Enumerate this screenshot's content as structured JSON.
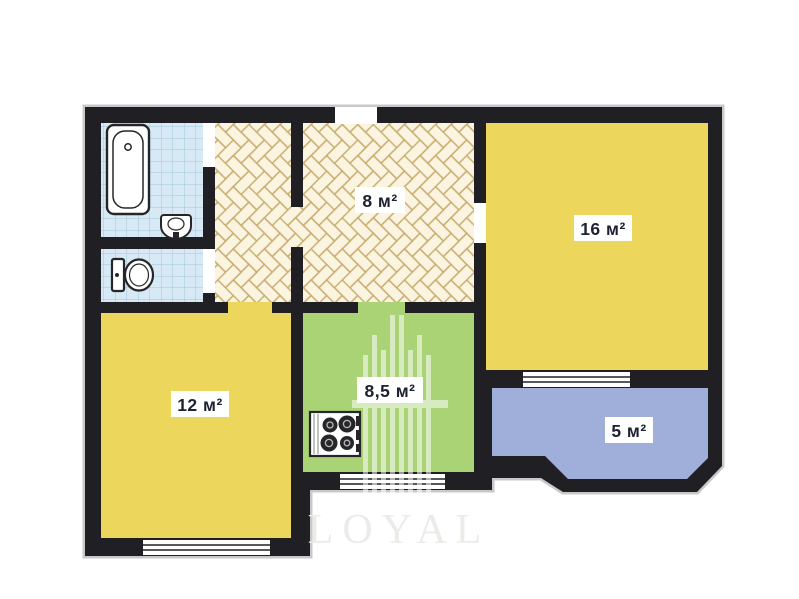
{
  "plan": {
    "title": "apartment-floor-plan",
    "rooms": [
      {
        "name": "hallway",
        "area_label": "8 м²"
      },
      {
        "name": "living-room",
        "area_label": "16 м²"
      },
      {
        "name": "bedroom",
        "area_label": "12 м²"
      },
      {
        "name": "kitchen",
        "area_label": "8,5 м²"
      },
      {
        "name": "balcony",
        "area_label": "5 м²"
      }
    ],
    "fixtures": [
      "bathtub-icon",
      "sink-icon",
      "toilet-icon",
      "stove-icon"
    ],
    "watermark": {
      "text": "LOYAL"
    },
    "colors": {
      "wall": "#202024",
      "room_yellow": "#ecd75c",
      "kitchen_green": "#a9d374",
      "balcony_blue": "#a0aeda",
      "parquet_cream": "#fbf4e0",
      "parquet_line": "#c6ac6c",
      "tile_blue": "#d6e9f4",
      "tile_line": "#a3c6da",
      "label_text": "#1c2230",
      "door_opening": "#ffffff"
    }
  }
}
